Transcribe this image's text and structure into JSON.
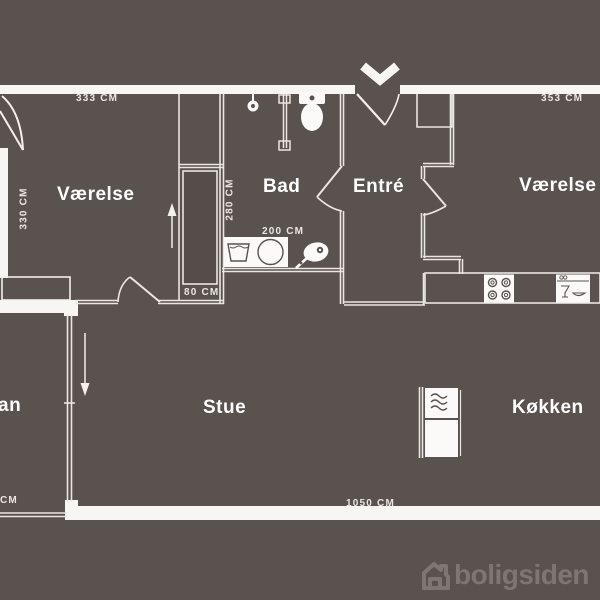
{
  "palette": {
    "background": "#5a524f",
    "wall": "#f8f6f3",
    "thin_line": "#eae6e2",
    "fixture_fill": "#fbfaf8",
    "room_text": "#ffffff",
    "logo_color": "#7d7672"
  },
  "rooms": {
    "vaerelse_left": {
      "label": "Værelse"
    },
    "bad": {
      "label": "Bad"
    },
    "entre": {
      "label": "Entré"
    },
    "vaerelse_right": {
      "label": "Værelse"
    },
    "stue": {
      "label": "Stue"
    },
    "koekken": {
      "label": "Køkken"
    },
    "altan_partial": {
      "label": "an"
    }
  },
  "measurements": {
    "top_left": "333 CM",
    "left_vertical": "330 CM",
    "closet_vertical": "280 CM",
    "bad_width": "200 CM",
    "hall_width": "80 CM",
    "top_right": "353 CM",
    "bottom_total": "1050 CM",
    "balcony_partial": "CM"
  },
  "fixtures": [
    "entrance-chevron-icon",
    "entrance-door-arc",
    "shower-icon",
    "shower-partition",
    "toilet-icon",
    "hand-basin-icon",
    "washing-machine-icon",
    "floor-drain-icon",
    "stove-icon",
    "dishwasher-icon",
    "fridge-freezer-icon",
    "wardrobe-closets",
    "direction-arrow-up",
    "direction-arrow-down"
  ],
  "logo": {
    "text": "boligsiden",
    "icon": "house-icon"
  }
}
